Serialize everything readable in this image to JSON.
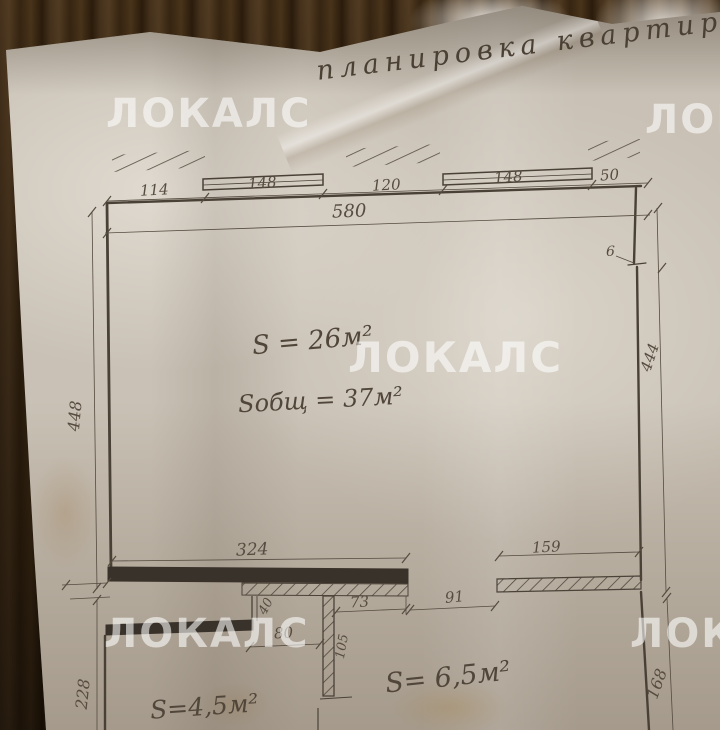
{
  "photo": {
    "title": "планировка квартиры",
    "watermark": "ЛОКАЛС"
  },
  "plan": {
    "areas": {
      "main_room": "S = 26м²",
      "total": "Sобщ = 37м²",
      "left_room": "S=4,5м²",
      "right_room": "S= 6,5м²"
    },
    "dims": {
      "top_1": "114",
      "top_2": "148",
      "top_3": "120",
      "top_4": "148",
      "top_5": "50",
      "top_total": "580",
      "left_height": "448",
      "right_height": "444",
      "notch": "6",
      "bottom_wall_left": "324",
      "bottom_wall_right": "159",
      "hall_width": "73",
      "door_opening": "91",
      "stub": "40",
      "opening_small": "80",
      "wall_length": "105",
      "left_lower_height": "228",
      "right_lower_height": "168"
    }
  }
}
